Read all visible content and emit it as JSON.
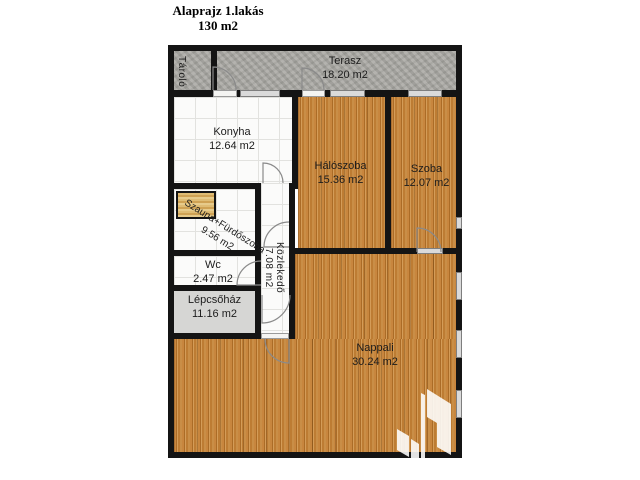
{
  "page": {
    "title": "Alaprajz 1.lakás",
    "subtitle": "130 m2"
  },
  "rooms": {
    "tarolo": {
      "name": "Tároló"
    },
    "terasz": {
      "name": "Terasz",
      "area": "18.20 m2"
    },
    "konyha": {
      "name": "Konyha",
      "area": "12.64 m2"
    },
    "haloszoba": {
      "name": "Hálószoba",
      "area": "15.36 m2"
    },
    "szoba": {
      "name": "Szoba",
      "area": "12.07 m2"
    },
    "szauna_furdoszoba": {
      "name": "Szauna+Fürdőszoba",
      "area": "9.56 m2"
    },
    "wc": {
      "name": "Wc",
      "area": "2.47 m2"
    },
    "kozlekedo": {
      "name": "Közlekedő",
      "area": "7.08 m2"
    },
    "lepcsohaz": {
      "name": "Lépcsőház",
      "area": "11.16 m2"
    },
    "nappali": {
      "name": "Nappali",
      "area": "30.24 m2"
    }
  },
  "colors": {
    "wall": "#141414",
    "wood_floor": "#bc7c34",
    "concrete": "#a8a7a2",
    "stairs": "#d6d6d4",
    "tile_floor": "#fbfbfa",
    "sauna_wood": "#d9b267",
    "window_sill": "#dadada",
    "label_text": "#1c1c1c"
  }
}
